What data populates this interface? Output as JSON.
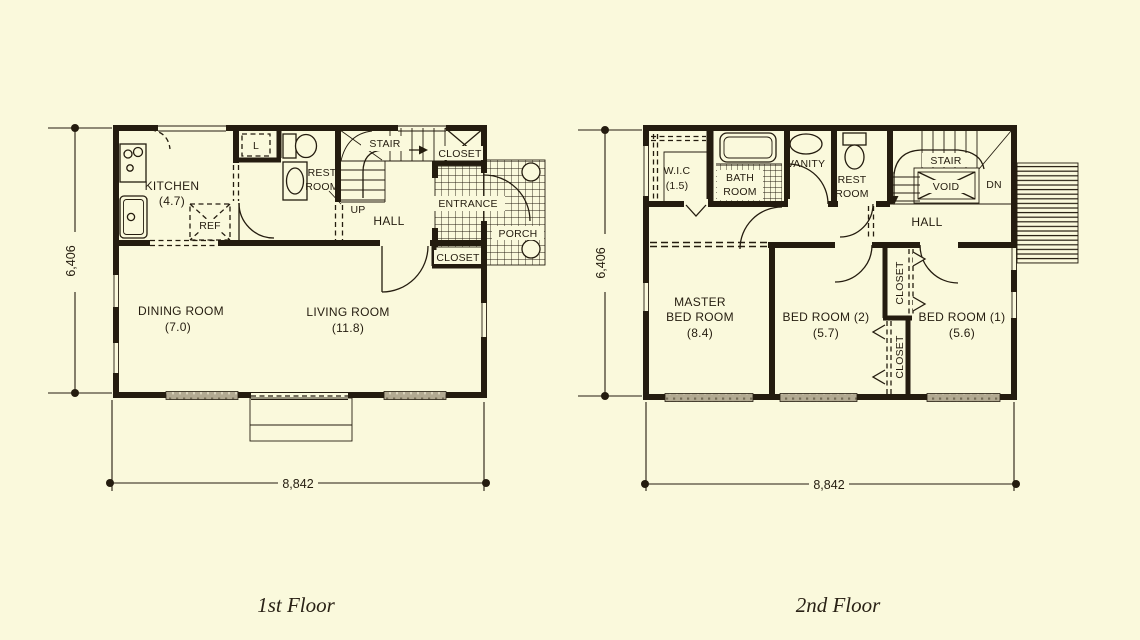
{
  "colors": {
    "paper": "#faf9dc",
    "ink": "#241c0f",
    "window_hatch": "#b2aa92"
  },
  "f1": {
    "caption": "1st Floor",
    "kitchen": "KITCHEN",
    "kitchen_area": "(4.7)",
    "ref": "REF",
    "linen": "L",
    "rest_1": "REST",
    "rest_2": "ROOM",
    "stair": "STAIR",
    "closet_top": "CLOSET",
    "up": "UP",
    "hall": "HALL",
    "entrance": "ENTRANCE",
    "closet_bottom": "CLOSET",
    "porch": "PORCH",
    "dining": "DINING ROOM",
    "dining_area": "(7.0)",
    "living": "LIVING ROOM",
    "living_area": "(11.8)",
    "dim_width": "8,842",
    "dim_height": "6,406"
  },
  "f2": {
    "caption": "2nd Floor",
    "wic": "W.I.C",
    "wic_area": "(1.5)",
    "bath_1": "BATH",
    "bath_2": "ROOM",
    "vanity": "VANITY",
    "rest_1": "REST",
    "rest_2": "ROOM",
    "stair": "STAIR",
    "void": "VOID",
    "dn": "DN",
    "hall": "HALL",
    "master_1": "MASTER",
    "master_2": "BED ROOM",
    "master_area": "(8.4)",
    "bed2": "BED ROOM (2)",
    "bed2_area": "(5.7)",
    "bed1": "BED ROOM (1)",
    "bed1_area": "(5.6)",
    "closet_upper": "CLOSET",
    "closet_lower": "CLOSET",
    "dim_width": "8,842",
    "dim_height": "6,406"
  }
}
